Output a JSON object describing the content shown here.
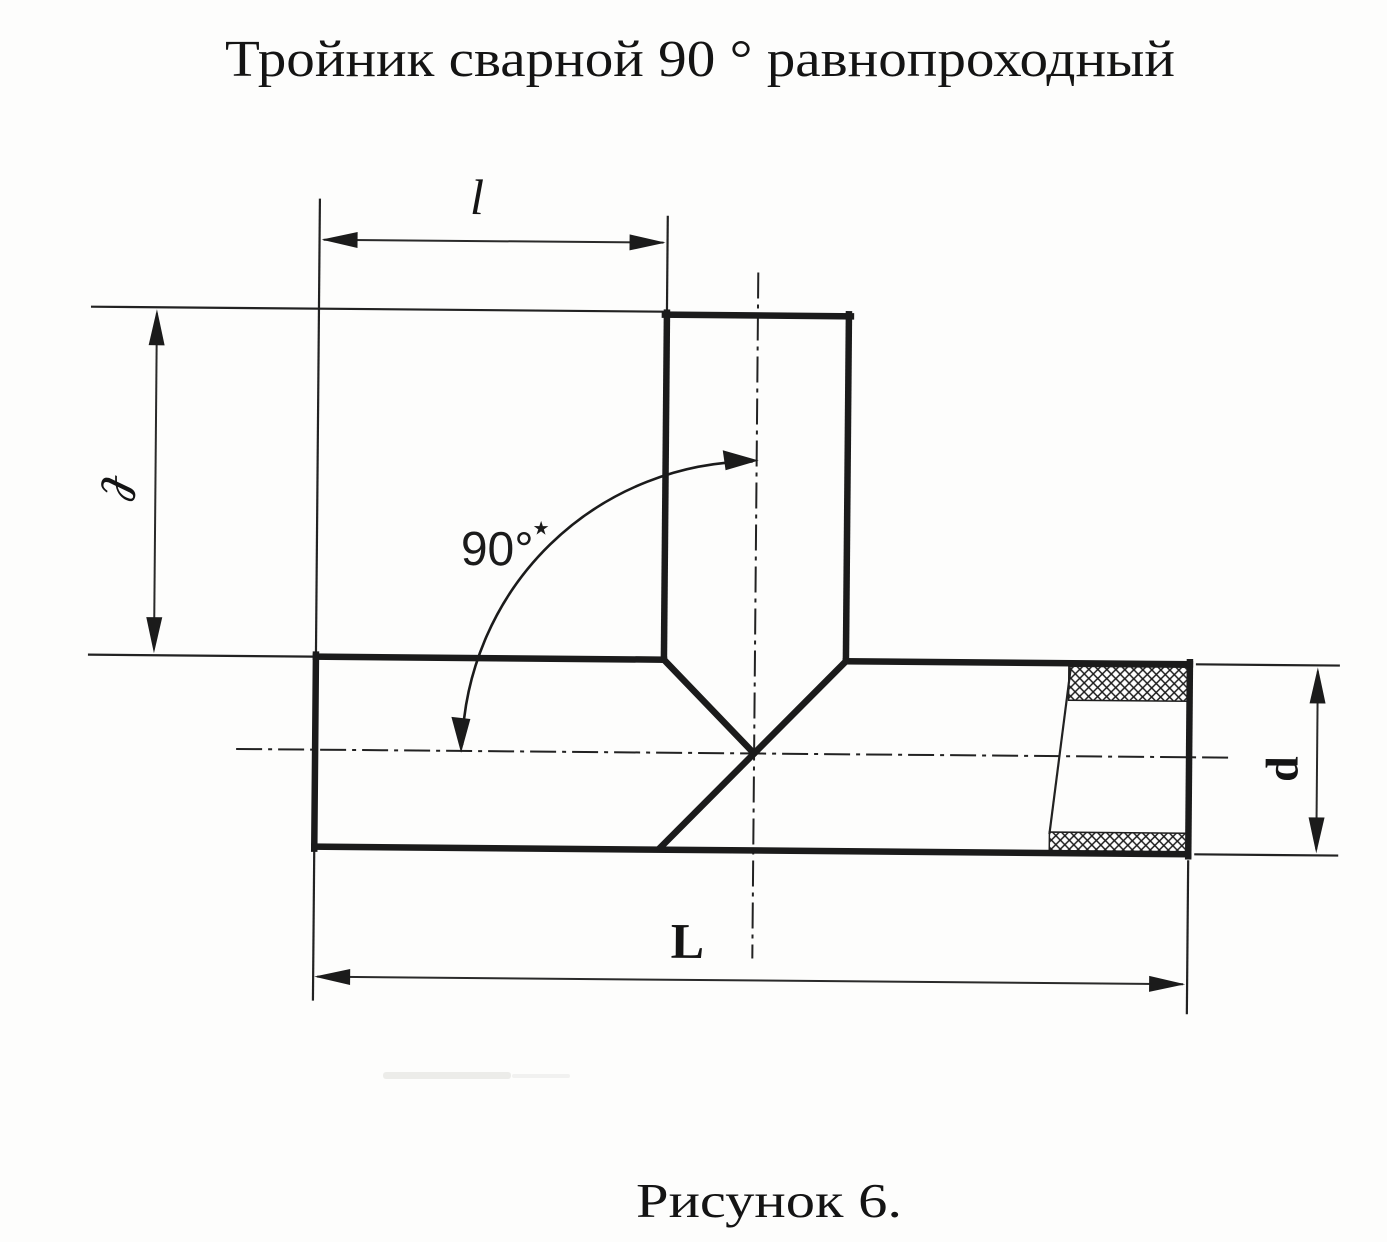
{
  "page": {
    "title": "Тройник сварной 90 ° равнопроходный",
    "caption": "Рисунок 6."
  },
  "labels": {
    "dim_top": "l",
    "dim_left": "ℓ",
    "dim_length": "L",
    "dim_diameter": "d",
    "angle": "90°",
    "angle_footnote": "★"
  },
  "colors": {
    "ink": "#1b1b1b",
    "paper": "#fdfdfc"
  }
}
